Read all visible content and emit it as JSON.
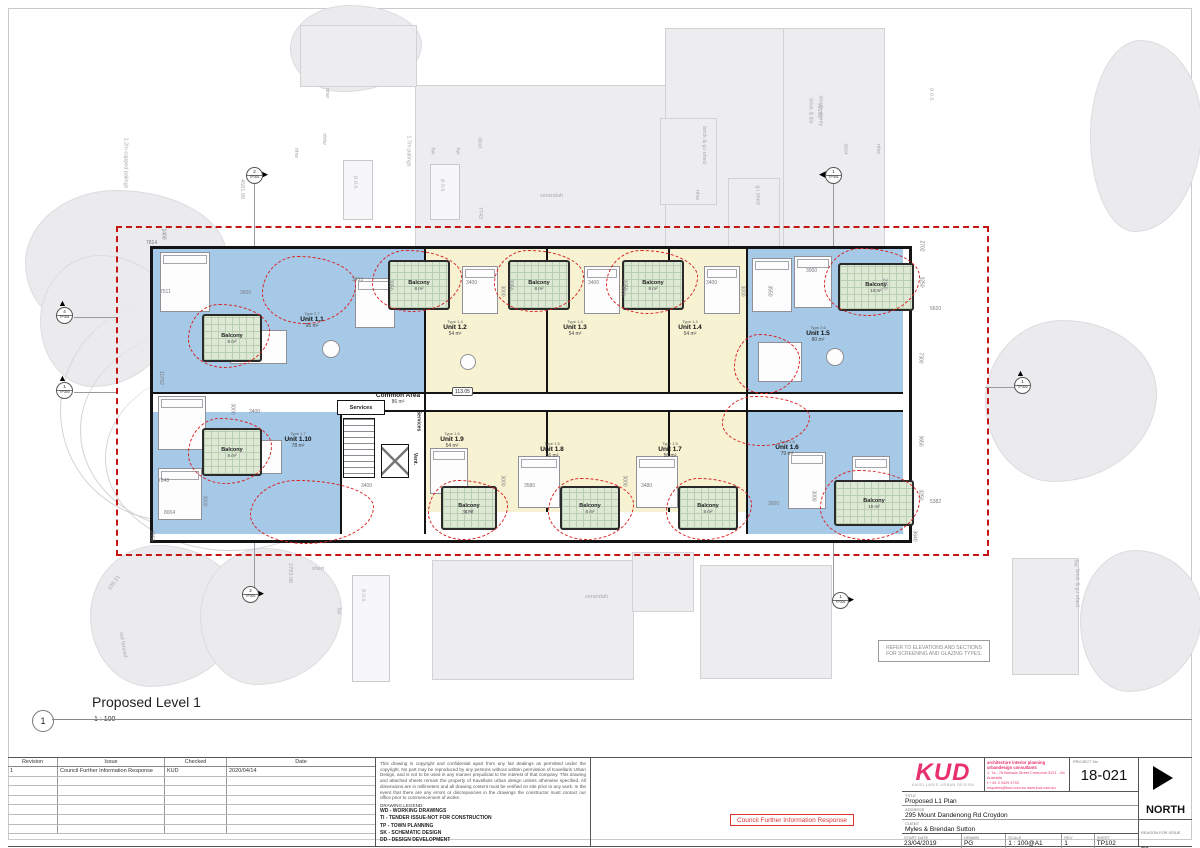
{
  "colors": {
    "unit_blue": "#a6c9e8",
    "unit_yellow": "#f6f2d2",
    "balcony_green": "#dde8d5",
    "revision_red": "#d92222",
    "boundary_red": "#c41414",
    "kud_pink": "#e8316e"
  },
  "drawing_title": {
    "number": "1",
    "name": "Proposed Level 1",
    "scale": "1 : 100"
  },
  "plan": {
    "common_area": {
      "label": "Common Area",
      "area": "86 m²"
    },
    "services_h": "Services",
    "services_v": "Services",
    "vent": "Vent.",
    "level": "113.05",
    "note_box": "REFER TO ELEVATIONS AND SECTIONS FOR SCREENING AND GLAZING TYPES.",
    "units": [
      {
        "name": "Unit 1.1",
        "type": "Type 2.7",
        "area": "95 m²",
        "x": 312,
        "y": 320
      },
      {
        "name": "Unit 1.2",
        "type": "Type 1.4",
        "area": "54 m²",
        "x": 455,
        "y": 328
      },
      {
        "name": "Unit 1.3",
        "type": "Type 1.4",
        "area": "54 m²",
        "x": 575,
        "y": 328
      },
      {
        "name": "Unit 1.4",
        "type": "Type 1.4",
        "area": "54 m²",
        "x": 690,
        "y": 328
      },
      {
        "name": "Unit 1.5",
        "type": "Type 2.6",
        "area": "80 m²",
        "x": 818,
        "y": 334
      },
      {
        "name": "Unit 1.6",
        "type": "Type 2.6",
        "area": "79 m²",
        "x": 787,
        "y": 448
      },
      {
        "name": "Unit 1.7",
        "type": "Type 1.5",
        "area": "56 m²",
        "x": 670,
        "y": 450
      },
      {
        "name": "Unit 1.8",
        "type": "Type 1.5",
        "area": "56 m²",
        "x": 552,
        "y": 450
      },
      {
        "name": "Unit 1.9",
        "type": "Type 1.6",
        "area": "54 m²",
        "x": 452,
        "y": 440
      },
      {
        "name": "Unit 1.10",
        "type": "Type 1.7",
        "area": "78 m²",
        "x": 298,
        "y": 440
      }
    ],
    "balconies": [
      {
        "label": "Balcony",
        "area": "8 m²",
        "x": 202,
        "y": 314,
        "w": 56,
        "h": 44
      },
      {
        "label": "Balcony",
        "area": "8 m²",
        "x": 202,
        "y": 428,
        "w": 56,
        "h": 44
      },
      {
        "label": "Balcony",
        "area": "8 m²",
        "x": 388,
        "y": 260,
        "w": 58,
        "h": 46
      },
      {
        "label": "Balcony",
        "area": "8 m²",
        "x": 508,
        "y": 260,
        "w": 58,
        "h": 46
      },
      {
        "label": "Balcony",
        "area": "8 m²",
        "x": 622,
        "y": 260,
        "w": 58,
        "h": 46
      },
      {
        "label": "Balcony",
        "area": "10 m²",
        "x": 838,
        "y": 263,
        "w": 72,
        "h": 44
      },
      {
        "label": "Balcony",
        "area": "8 m²",
        "x": 441,
        "y": 486,
        "w": 52,
        "h": 40
      },
      {
        "label": "Balcony",
        "area": "8 m²",
        "x": 560,
        "y": 486,
        "w": 56,
        "h": 40
      },
      {
        "label": "Balcony",
        "area": "8 m²",
        "x": 678,
        "y": 486,
        "w": 56,
        "h": 40
      },
      {
        "label": "Balcony",
        "area": "10 m²",
        "x": 834,
        "y": 480,
        "w": 76,
        "h": 42
      }
    ],
    "markers": [
      {
        "num": "2",
        "ref": "TP301",
        "glyph": "▶",
        "pos": "right",
        "x": 244,
        "y": 163
      },
      {
        "num": "1",
        "ref": "TP301",
        "glyph": "◀",
        "pos": "left",
        "x": 823,
        "y": 163
      },
      {
        "num": "4",
        "ref": "TP301",
        "glyph": "▲",
        "pos": "up",
        "x": 54,
        "y": 303
      },
      {
        "num": "1",
        "ref": "TP300",
        "glyph": "▲",
        "pos": "up",
        "x": 54,
        "y": 378
      },
      {
        "num": "1",
        "ref": "TP300",
        "glyph": "▲",
        "pos": "up",
        "x": 1012,
        "y": 373
      },
      {
        "num": "2",
        "ref": "TP301",
        "glyph": "▶",
        "pos": "right",
        "x": 240,
        "y": 582
      },
      {
        "num": "1",
        "ref": "TP301",
        "glyph": "▶",
        "pos": "right",
        "x": 830,
        "y": 588
      }
    ],
    "dimensions": [
      {
        "t": "1400",
        "x": 158,
        "y": 231,
        "r": 90
      },
      {
        "t": "7814",
        "x": 146,
        "y": 240
      },
      {
        "t": "7511",
        "x": 160,
        "y": 289
      },
      {
        "t": "10752",
        "x": 154,
        "y": 375,
        "r": 90
      },
      {
        "t": "7648",
        "x": 158,
        "y": 478
      },
      {
        "t": "8004",
        "x": 164,
        "y": 510
      },
      {
        "t": "2059",
        "x": 146,
        "y": 533,
        "r": 90
      },
      {
        "t": "2702",
        "x": 916,
        "y": 243,
        "r": 90
      },
      {
        "t": "3250",
        "x": 916,
        "y": 279,
        "r": 90
      },
      {
        "t": "5620",
        "x": 930,
        "y": 306
      },
      {
        "t": "7300",
        "x": 915,
        "y": 355,
        "r": 90
      },
      {
        "t": "3650",
        "x": 915,
        "y": 438,
        "r": 90
      },
      {
        "t": "3250",
        "x": 915,
        "y": 492,
        "r": 90
      },
      {
        "t": "5382",
        "x": 930,
        "y": 499
      },
      {
        "t": "3640",
        "x": 909,
        "y": 533,
        "r": 90
      },
      {
        "t": "3600",
        "x": 240,
        "y": 290
      },
      {
        "t": "3433",
        "x": 352,
        "y": 277
      },
      {
        "t": "3400",
        "x": 466,
        "y": 280
      },
      {
        "t": "3400",
        "x": 588,
        "y": 280
      },
      {
        "t": "3400",
        "x": 706,
        "y": 280
      },
      {
        "t": "2050",
        "x": 385,
        "y": 282,
        "r": 90
      },
      {
        "t": "2050",
        "x": 505,
        "y": 282,
        "r": 90
      },
      {
        "t": "2050",
        "x": 619,
        "y": 282,
        "r": 90
      },
      {
        "t": "3000",
        "x": 497,
        "y": 288,
        "r": 90
      },
      {
        "t": "3000",
        "x": 617,
        "y": 288,
        "r": 90
      },
      {
        "t": "3000",
        "x": 737,
        "y": 288,
        "r": 90
      },
      {
        "t": "3000",
        "x": 806,
        "y": 268
      },
      {
        "t": "3550",
        "x": 764,
        "y": 288,
        "r": 90
      },
      {
        "t": "2150",
        "x": 879,
        "y": 281,
        "r": 90
      },
      {
        "t": "3400",
        "x": 249,
        "y": 409
      },
      {
        "t": "3000",
        "x": 227,
        "y": 406,
        "r": 90
      },
      {
        "t": "3400",
        "x": 361,
        "y": 483
      },
      {
        "t": "3580",
        "x": 524,
        "y": 483
      },
      {
        "t": "3480",
        "x": 641,
        "y": 483
      },
      {
        "t": "3000",
        "x": 497,
        "y": 478,
        "r": 90
      },
      {
        "t": "3000",
        "x": 619,
        "y": 478,
        "r": 90
      },
      {
        "t": "3000",
        "x": 768,
        "y": 501
      },
      {
        "t": "3000",
        "x": 808,
        "y": 493,
        "r": 90
      },
      {
        "t": "3679",
        "x": 462,
        "y": 510
      },
      {
        "t": "3000",
        "x": 199,
        "y": 498,
        "r": 90
      }
    ],
    "context_labels": [
      {
        "t": "1.2m capped palings",
        "x": 100,
        "y": 160,
        "r": 90
      },
      {
        "t": "4581.99",
        "x": 232,
        "y": 186,
        "r": 90
      },
      {
        "t": "verandah",
        "x": 540,
        "y": 193
      },
      {
        "t": "1.7m palings",
        "x": 393,
        "y": 148,
        "r": 90
      },
      {
        "t": "nhw",
        "x": 322,
        "y": 90,
        "r": 90
      },
      {
        "t": "nhfw",
        "x": 318,
        "y": 136,
        "r": 90
      },
      {
        "t": "nhw",
        "x": 291,
        "y": 150,
        "r": 90
      },
      {
        "t": "hw",
        "x": 429,
        "y": 148,
        "r": 90
      },
      {
        "t": "hw",
        "x": 454,
        "y": 148,
        "r": 90
      },
      {
        "t": "door",
        "x": 474,
        "y": 140,
        "r": 90
      },
      {
        "t": "p.o.s.",
        "x": 349,
        "y": 180,
        "r": 90
      },
      {
        "t": "p.o.s.",
        "x": 436,
        "y": 183,
        "r": 90
      },
      {
        "t": "brick & g.i shed",
        "x": 685,
        "y": 142,
        "r": 90
      },
      {
        "t": "nhw",
        "x": 692,
        "y": 192,
        "r": 90
      },
      {
        "t": "g.i shed",
        "x": 748,
        "y": 192,
        "r": 90
      },
      {
        "t": "4/293",
        "x": 812,
        "y": 108,
        "r": 90
      },
      {
        "t": "single storey",
        "x": 805,
        "y": 108,
        "r": 90
      },
      {
        "t": "brick & tile",
        "x": 798,
        "y": 108,
        "r": 90
      },
      {
        "t": "door",
        "x": 840,
        "y": 146,
        "r": 90
      },
      {
        "t": "nhw",
        "x": 873,
        "y": 146,
        "r": 90
      },
      {
        "t": "p.o.s.",
        "x": 925,
        "y": 92,
        "r": 90
      },
      {
        "t": "7743",
        "x": 474,
        "y": 210,
        "r": 90
      },
      {
        "t": "109.21",
        "x": 106,
        "y": 580,
        "r": -55
      },
      {
        "t": "not fenced",
        "x": 110,
        "y": 642,
        "r": 80
      },
      {
        "t": "2783.08",
        "x": 280,
        "y": 570,
        "r": 90
      },
      {
        "t": "shed",
        "x": 312,
        "y": 566
      },
      {
        "t": "hw",
        "x": 335,
        "y": 608,
        "r": 90
      },
      {
        "t": "p.o.s.",
        "x": 357,
        "y": 593,
        "r": 90
      },
      {
        "t": "verandah",
        "x": 585,
        "y": 594
      },
      {
        "t": "brick & g.i shed",
        "x": 1058,
        "y": 585,
        "r": 90
      },
      {
        "t": "hw",
        "x": 1072,
        "y": 560,
        "r": 90
      }
    ],
    "clouds": [
      {
        "x": 372,
        "y": 250,
        "w": 88,
        "h": 60
      },
      {
        "x": 494,
        "y": 250,
        "w": 88,
        "h": 60
      },
      {
        "x": 606,
        "y": 250,
        "w": 90,
        "h": 62
      },
      {
        "x": 824,
        "y": 248,
        "w": 94,
        "h": 66
      },
      {
        "x": 188,
        "y": 304,
        "w": 80,
        "h": 62
      },
      {
        "x": 188,
        "y": 418,
        "w": 82,
        "h": 64
      },
      {
        "x": 262,
        "y": 256,
        "w": 92,
        "h": 66
      },
      {
        "x": 250,
        "y": 480,
        "w": 122,
        "h": 62
      },
      {
        "x": 428,
        "y": 480,
        "w": 78,
        "h": 58
      },
      {
        "x": 548,
        "y": 478,
        "w": 84,
        "h": 60
      },
      {
        "x": 666,
        "y": 478,
        "w": 84,
        "h": 60
      },
      {
        "x": 820,
        "y": 470,
        "w": 98,
        "h": 68
      },
      {
        "x": 734,
        "y": 334,
        "w": 64,
        "h": 58
      },
      {
        "x": 722,
        "y": 396,
        "w": 86,
        "h": 48
      }
    ]
  },
  "sheet": {
    "revision_table": {
      "headers": [
        "Revision",
        "Issue",
        "Checked",
        "Date"
      ],
      "rows": [
        [
          "1",
          "Council Further Information Response",
          "KUD",
          "2020/04/14"
        ]
      ]
    },
    "notes": {
      "copyright": "This drawing is copyright and confidential apart from any fair dealings as permitted under the copyright. No part may be reproduced by any persons without written permission of Kavellaris Urban Design, and is not to be used in any manner prejudicial to the interest of that company. This drawing and attached sheets remain the property of Kavellaris urban design unless otherwise specified. All dimensions are in millimeters and all drawing content must be verified on site prior to any work. In the event that there are any errors or discrepancies in the drawings the constructor must contact our office prior to commencement of works.",
      "legend_title": "DRAWING LEGEND:",
      "legend": [
        "WD - WORKING DRAWINGS",
        "TI -  TENDER ISSUE-NOT FOR CONSTRUCTION",
        "TP -  TOWN PLANNING",
        "SK -  SCHEMATIC DESIGN",
        "DD -  DESIGN DEVELOPMENT"
      ]
    },
    "stamp": "Council Further Information Response",
    "title_block": {
      "logo": "KUD",
      "logo_sub": "KAVELLARIS URBAN DESIGN",
      "consultant_line": "architecture interior planning urbandesign consultants",
      "consultant_address": "1, 7a - 78 Balmain Street Cremorne 3121 - Vic Australia",
      "consultant_phone": "t + 61 3 9429 4733",
      "consultant_email": "enquiries@kud.com.au   www.kud.com.au",
      "project_no_label": "PROJECT No",
      "project_no": "18-021",
      "title_label": "TITLE",
      "title": "Proposed L1 Plan",
      "address_label": "ADDRESS",
      "address": "295 Mount Dandenong Rd Croydon",
      "client_label": "CLIENT",
      "client": "Myles & Brendan Sutton",
      "start_date_label": "START DATE",
      "start_date": "23/04/2019",
      "drawn_label": "DRAWN",
      "drawn": "PG",
      "scale_label": "SCALE",
      "scale": "1 : 100@A1",
      "rev_label": "REV",
      "rev": "1",
      "sheet_label": "SHEET",
      "sheet_no": "TP102",
      "reason_label": "REASON FOR ISSUE",
      "reason": "TP",
      "north_label": "NORTH"
    }
  }
}
